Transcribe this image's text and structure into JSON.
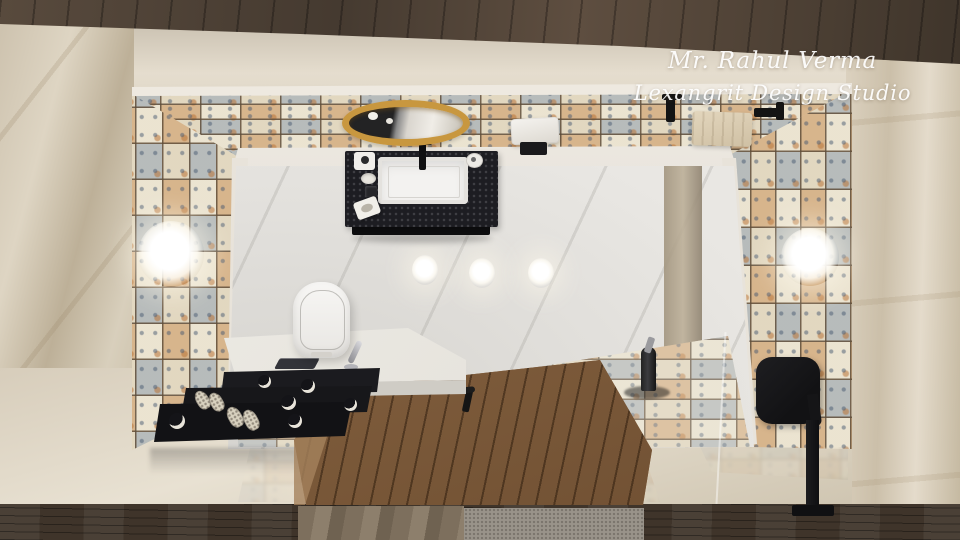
{
  "watermark": {
    "line1": "Mr. Rahul Verma",
    "line2": "Lexangrit Design Studio",
    "color": "#ffffff"
  },
  "scene": {
    "type": "3d-interior-render",
    "view": "top-down-bathroom",
    "objects": [
      "round-gold-mirror",
      "black-granite-vanity",
      "white-sink",
      "black-faucet",
      "toilet",
      "white-side-counter",
      "black-drawers",
      "slippers",
      "phone",
      "wooden-deck-door",
      "deck-handle",
      "patchwork-tile-walls",
      "shower-tile-floor",
      "black-shower-head",
      "shower-pole",
      "floor-mounted-faucet",
      "floor-drain",
      "wall-sconce-left",
      "wall-sconce-right",
      "white-towel",
      "beige-towel",
      "towel-hooks",
      "marble-floor",
      "ceiling-light-reflections"
    ]
  },
  "palette": {
    "gold_accent": "#c8973f",
    "tile_rust": "#c07a40",
    "tile_blue": "#8fa0b5",
    "tile_cream": "#e6dcc4",
    "grout": "#60503a",
    "marble_beige": "#d8ccb8",
    "floor_marble_white": "#e9e7e3",
    "fixture_black": "#17171a",
    "deck_wood": "#8a6747",
    "dark_wood": "#46392f"
  }
}
